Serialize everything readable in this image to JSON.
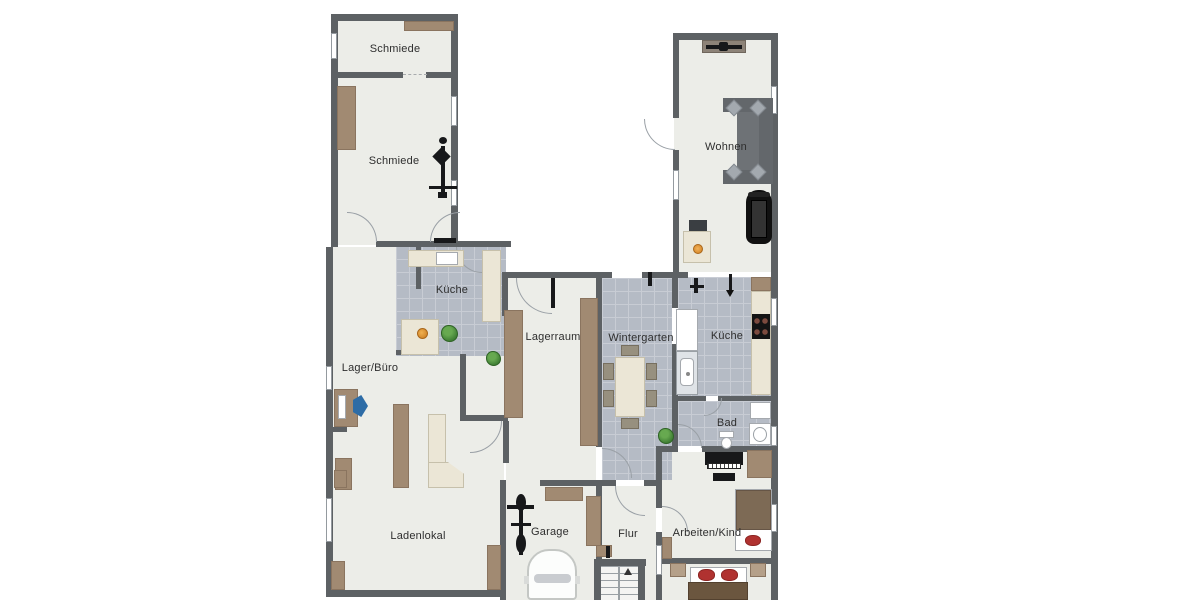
{
  "rooms": [
    {
      "id": "schmiede-top",
      "label": "Schmiede"
    },
    {
      "id": "schmiede-main",
      "label": "Schmiede"
    },
    {
      "id": "kueche-left",
      "label": "Küche"
    },
    {
      "id": "lager-buero",
      "label": "Lager/Büro"
    },
    {
      "id": "lagerraum",
      "label": "Lagerraum"
    },
    {
      "id": "wintergarten",
      "label": "Wintergarten"
    },
    {
      "id": "kueche-right",
      "label": "Küche"
    },
    {
      "id": "wohnen",
      "label": "Wohnen"
    },
    {
      "id": "bad",
      "label": "Bad"
    },
    {
      "id": "arbeiten-kind",
      "label": "Arbeiten/Kind"
    },
    {
      "id": "ladenlokal",
      "label": "Ladenlokal"
    },
    {
      "id": "garage",
      "label": "Garage"
    },
    {
      "id": "flur",
      "label": "Flur"
    }
  ],
  "colors": {
    "wall": "#5d6164",
    "floor": "#ecede8",
    "tile": "#b5bbc5",
    "tileline": "#c8ccd4",
    "wood": "#a18a72",
    "woodd": "#8a745f",
    "cream": "#ebe6d6",
    "sofa": "#63676b",
    "black": "#17181a",
    "red": "#b03230",
    "orange": "#dd8f2e",
    "plant": "#3e7d33"
  },
  "furniture_legend": {
    "schmiede": [
      "workbench",
      "anvil"
    ],
    "kueche_left": [
      "counter-with-sink",
      "tall-cabinet",
      "dining-table",
      "fruit-bowl",
      "plant"
    ],
    "lager_buero": [
      "desk",
      "office-chair",
      "cabinet",
      "shelf"
    ],
    "lagerraum": [
      "shelf-left",
      "shelf-right",
      "plant"
    ],
    "wintergarten": [
      "dining-table",
      "chairs",
      "plant"
    ],
    "kueche_right": [
      "counter-with-stove",
      "fridge",
      "sink-unit"
    ],
    "wohnen": [
      "tv-sideboard",
      "corner-sofa",
      "treadmill",
      "fireplace"
    ],
    "bad": [
      "shower",
      "washbasin",
      "toilet"
    ],
    "arbeiten_kind": [
      "piano",
      "piano-bench",
      "bed",
      "wardrobe"
    ],
    "bedroom": [
      "double-bed",
      "nightstands"
    ],
    "garage": [
      "bicycle",
      "car",
      "shelves"
    ],
    "flur": [
      "staircase"
    ],
    "ladenlokal": [
      "sales-counter",
      "shelves"
    ]
  }
}
